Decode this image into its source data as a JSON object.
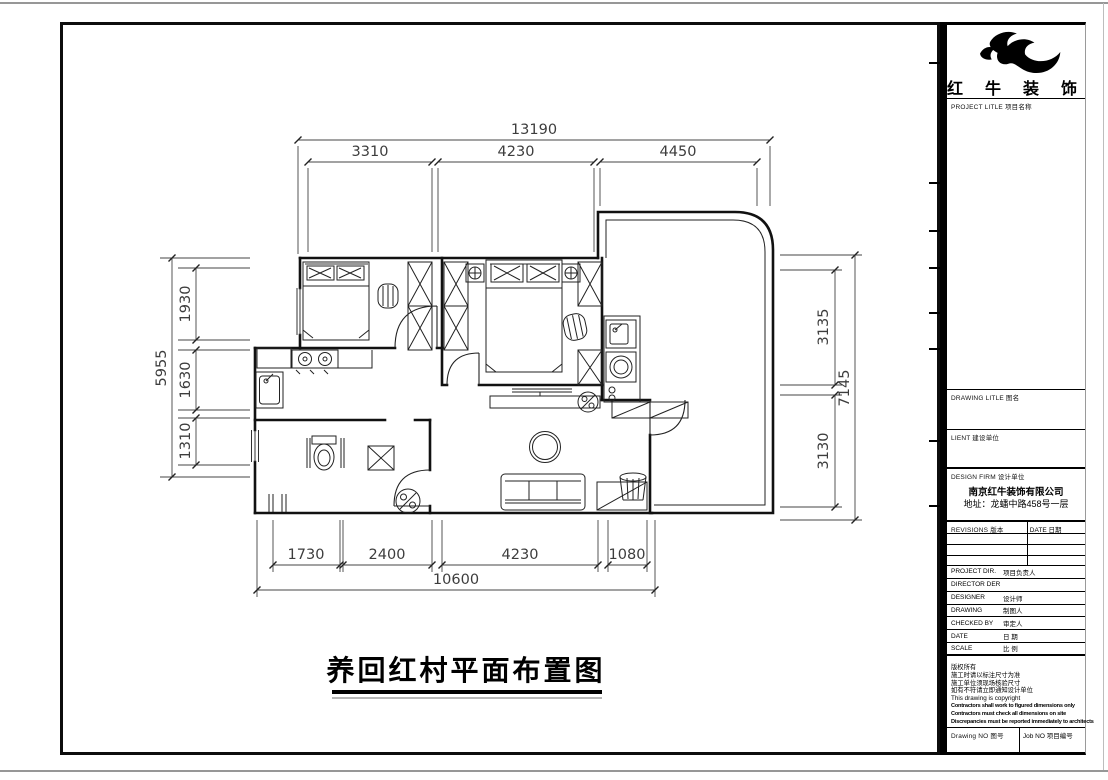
{
  "sheet": {
    "plan_title": "养回红村平面布置图"
  },
  "dims": {
    "top": {
      "overall": "13190",
      "segments": [
        "3310",
        "4230",
        "4450"
      ]
    },
    "bottom": {
      "overall": "10600",
      "segments": [
        "1730",
        "2400",
        "4230",
        "1080"
      ]
    },
    "left": {
      "overall": "5955",
      "segments": [
        "1930",
        "1630",
        "1310"
      ]
    },
    "right": {
      "overall": "7145",
      "segments": [
        "3135",
        "3130"
      ]
    }
  },
  "title_block": {
    "logo_text": "红 牛 装 饰",
    "project_title_label": "PROJECT LITLE  项目名称",
    "drawing_title_label": "DRAWING LITLE  图名",
    "client_label": "LIENT  建设单位",
    "design_firm_label": "DESIGN FIRM  设计单位",
    "firm_name": "南京红牛装饰有限公司",
    "firm_address": "地址：龙蟠中路458号一层",
    "revisions_label": "REVISIONS  版本",
    "date_col_label": "DATE  日期",
    "rows": [
      {
        "en": "PROJECT DIR.",
        "zh": "项目负责人"
      },
      {
        "en": "DIRECTOR DER",
        "zh": ""
      },
      {
        "en": "DESIGNER",
        "zh": "设计师"
      },
      {
        "en": "DRAWING",
        "zh": "制图人"
      },
      {
        "en": "CHECKED BY",
        "zh": "审定人"
      },
      {
        "en": "DATE",
        "zh": "日 期"
      },
      {
        "en": "SCALE",
        "zh": "比 例"
      }
    ],
    "notes": [
      "版权所有",
      "施工时请以标注尺寸为准",
      "施工单位须现场核验尺寸",
      "如有不符请立即通知设计单位",
      "This drawing is copyright",
      "Contractors shall work to figured dimensions only",
      "Contractors must check all dimensions on site",
      "Discrepancies must be reported immediately to architects"
    ],
    "drawing_no_label": "Drawing NO  图号",
    "job_no_label": "Job NO  项目编号"
  },
  "colors": {
    "ink": "#111111",
    "dim": "#3d3d3d",
    "edge": "#979797"
  }
}
